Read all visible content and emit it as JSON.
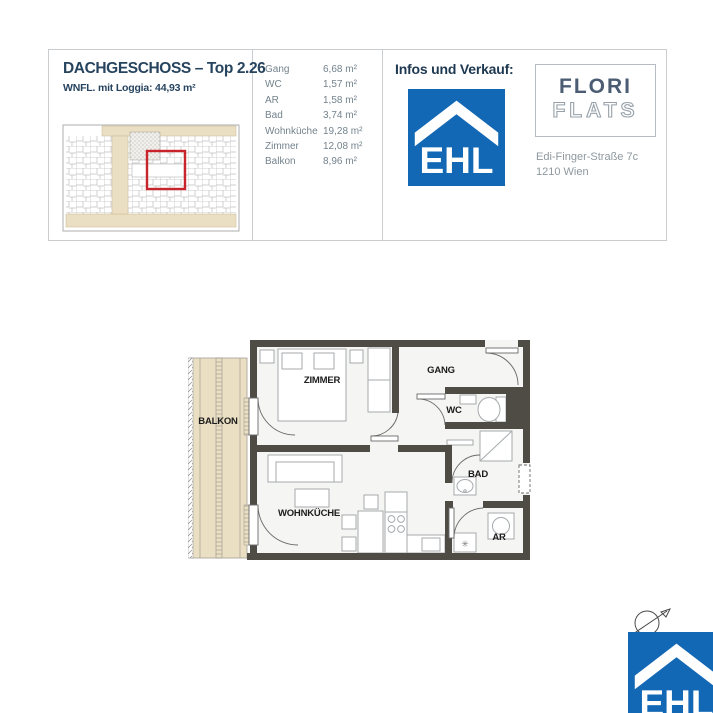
{
  "header": {
    "title": "DACHGESCHOSS – Top 2.26",
    "subtitle": "WNFL. mit Loggia: 44,93 m²",
    "rooms": [
      {
        "name": "Gang",
        "area": "6,68 m²"
      },
      {
        "name": "WC",
        "area": "1,57 m²"
      },
      {
        "name": "AR",
        "area": "1,58 m²"
      },
      {
        "name": "Bad",
        "area": "3,74 m²"
      },
      {
        "name": "Wohnküche",
        "area": "19,28 m²"
      },
      {
        "name": "Zimmer",
        "area": "12,08 m²"
      },
      {
        "name": "Balkon",
        "area": "8,96 m²"
      }
    ],
    "sales": {
      "label": "Infos und Verkauf:",
      "brand": "EHL",
      "project_line1": "FLORI",
      "project_line2": "FLATS",
      "address_line1": "Edi-Finger-Straße 7c",
      "address_line2": "1210 Wien"
    }
  },
  "plan": {
    "labels": {
      "balkon": "BALKON",
      "zimmer": "ZIMMER",
      "gang": "GANG",
      "wc": "WC",
      "bad": "BAD",
      "ar": "AR",
      "wohnkueche": "WOHNKÜCHE"
    }
  },
  "footer": {
    "brand": "EHL"
  },
  "colors": {
    "brand_blue": "#1368b5",
    "navy": "#27445f",
    "highlight_red": "#c9242b",
    "wall": "#4f4b45",
    "balcony_beige": "#ebdfc3"
  }
}
